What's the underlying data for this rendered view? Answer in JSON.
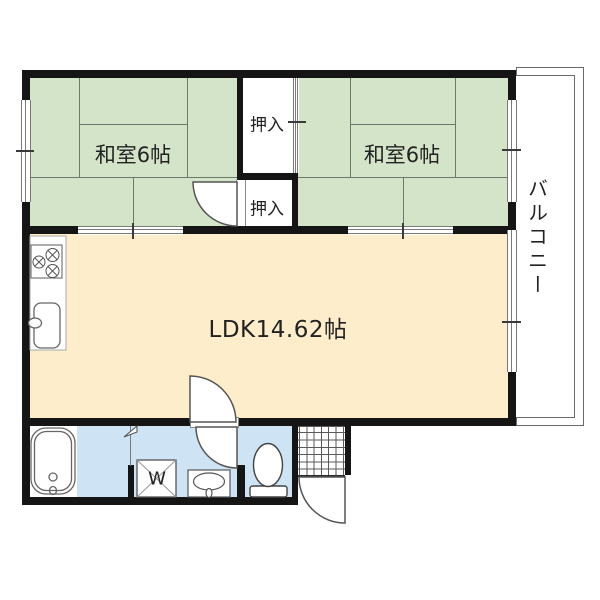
{
  "plan_type": "apartment-floor-plan",
  "labels": {
    "washitsu_left": "和室6帖",
    "washitsu_right": "和室6帖",
    "closet_upper": "押入",
    "closet_lower": "押入",
    "ldk": "LDK14.62帖",
    "balcony": "バルコニー",
    "washer": "W"
  },
  "rooms": [
    {
      "name": "washitsu-left",
      "label": "和室6帖",
      "type": "tatami-6-mat"
    },
    {
      "name": "washitsu-right",
      "label": "和室6帖",
      "type": "tatami-6-mat"
    },
    {
      "name": "closet-upper",
      "label": "押入",
      "type": "closet"
    },
    {
      "name": "closet-lower",
      "label": "押入",
      "type": "closet"
    },
    {
      "name": "ldk",
      "label": "LDK14.62帖",
      "type": "living-dining-kitchen"
    },
    {
      "name": "balcony",
      "label": "バルコニー",
      "type": "balcony"
    },
    {
      "name": "bathroom",
      "type": "bath",
      "fixtures": [
        "bathtub"
      ]
    },
    {
      "name": "washroom",
      "type": "utility",
      "fixtures": [
        "washing-machine",
        "washbasin"
      ]
    },
    {
      "name": "toilet-room",
      "type": "toilet",
      "fixtures": [
        "toilet"
      ]
    },
    {
      "name": "genkan",
      "type": "entrance",
      "fixtures": [
        "tile-floor",
        "entry-door"
      ]
    }
  ],
  "colors": {
    "tatami": "#d4e4c8",
    "ldk_floor": "#fdedca",
    "wet_floor": "#cee4f4",
    "wall": "#151515",
    "line": "#6b7a68"
  }
}
